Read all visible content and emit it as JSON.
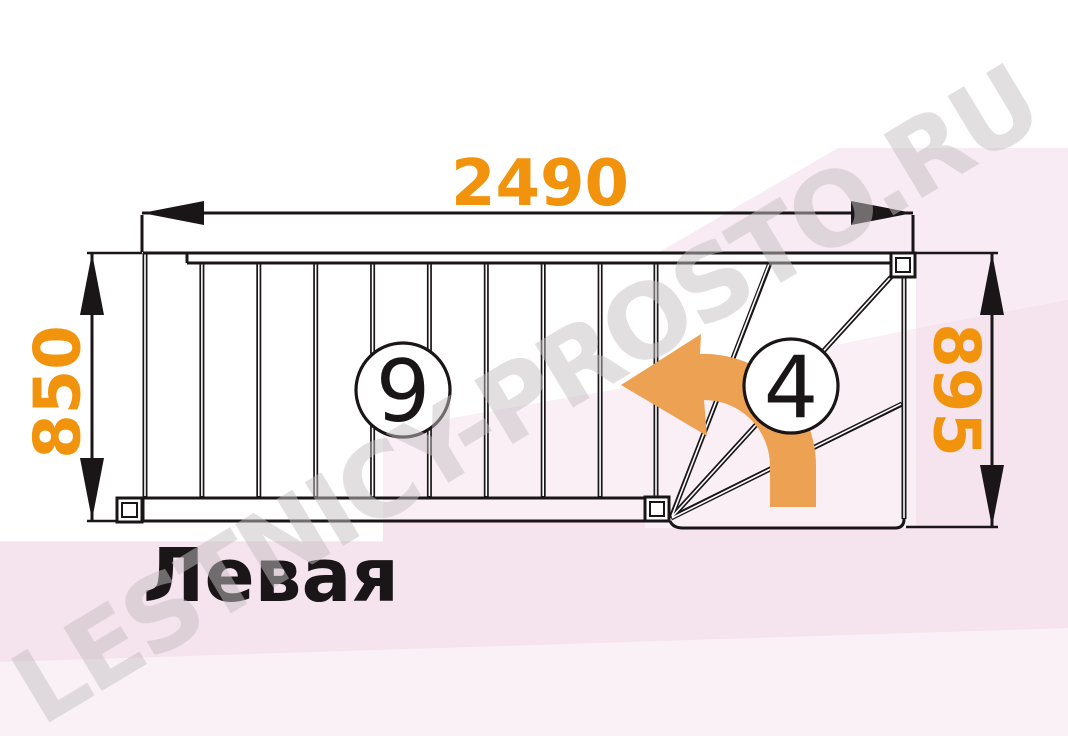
{
  "diagram": {
    "dimensions": {
      "length": "2490",
      "width_left": "850",
      "width_right": "895"
    },
    "step_counts": {
      "straight": "9",
      "winder": "4"
    },
    "caption": "Левая",
    "watermark": "LESTNICY-PROSTO.RU",
    "colors": {
      "dimension": "#f2930d",
      "arrow": "#eda152",
      "line": "#1a1517",
      "watermark_pink": "#f3dfec",
      "watermark_gray": "#c6c0c2"
    }
  }
}
